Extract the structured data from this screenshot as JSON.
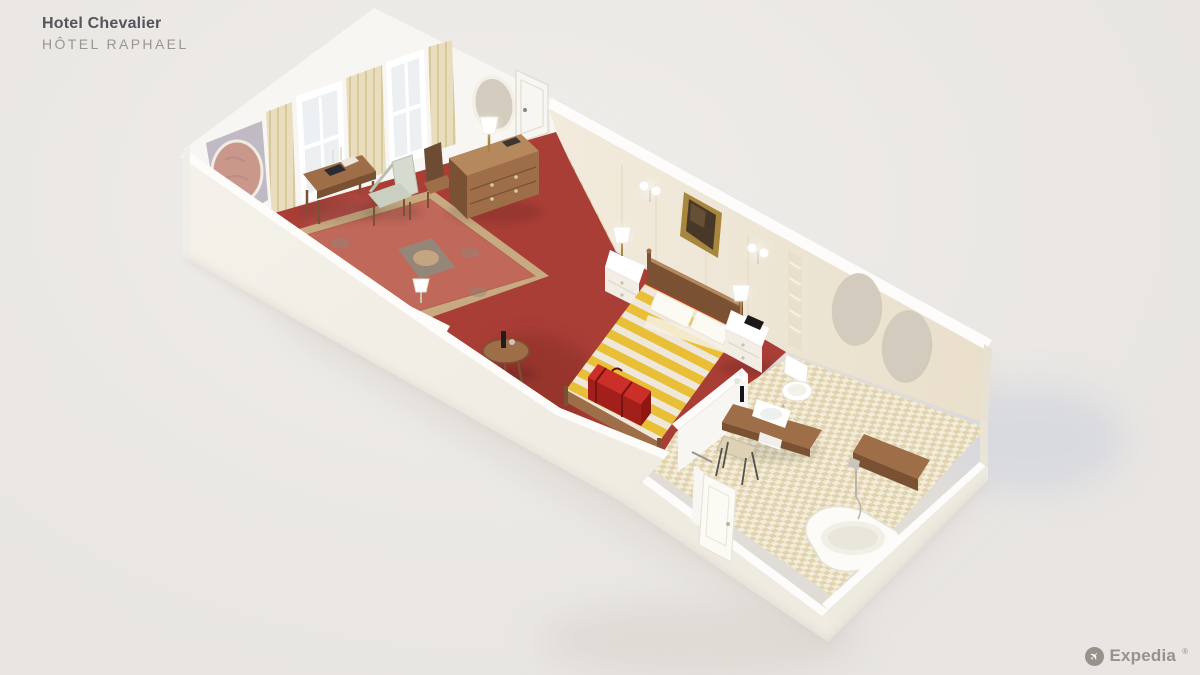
{
  "header": {
    "title": "Hotel Chevalier",
    "subtitle": "HÔTEL RAPHAEL"
  },
  "footer": {
    "brand": "Expedia",
    "registered_mark": "®",
    "plane_icon": "✈"
  },
  "scene": {
    "type": "isometric-floor-plan",
    "subject": "hotel suite cutaway 3D render",
    "rooms": [
      {
        "name": "Living room",
        "floor": "red carpet with oriental rug",
        "furniture": [
          "oriental rug",
          "writing desk with books and candlesticks",
          "armchair",
          "chest of drawers with table lamp",
          "side chair",
          "sofa",
          "fireplace mantel with lamp",
          "round side table with bottle",
          "two windows with cream curtains",
          "round mirror panel",
          "oval mirror",
          "paneled door"
        ]
      },
      {
        "name": "Bedroom",
        "floor": "red carpet",
        "furniture": [
          "double bed with yellow striped duvet",
          "white nightstand with lamp (left)",
          "white nightstand with lamp (right)",
          "gold framed painting",
          "two double wall sconces",
          "red suitcase on foot bench",
          "doorway privacy curtain"
        ]
      },
      {
        "name": "Bathroom",
        "floor": "beige checkered tile",
        "furniture": [
          "wooden vanity with white sink",
          "flower vase",
          "metal stool",
          "toilet",
          "two oval mirrors",
          "towel ladder",
          "bathtub with hand shower",
          "wooden corner bench",
          "open entry door"
        ]
      }
    ]
  },
  "colors": {
    "bg": "#e8e5e2",
    "bg_light": "#efedea",
    "shadow_warm": "#d9d4ce",
    "shadow_cool": "#d6d8df",
    "wall_white": "#f8f6f2",
    "wall_top": "#fdfcfa",
    "wall_cream": "#f2ebdd",
    "wall_cream_dark": "#e9dfcb",
    "wall_gray": "#bfbac3",
    "near_wall": "#f4f1ea",
    "near_wall_dark": "#efebe1",
    "carpet": "#a93e36",
    "carpet_dark": "#862d28",
    "rug_field": "#c0685a",
    "rug_border": "#c8aa82",
    "rug_accent": "#8f8a7c",
    "tile": "#f2ecd9",
    "tile_check": "#dbcba2",
    "wood": "#9e6e48",
    "wood_dark": "#7a5133",
    "wood_light": "#b5885e",
    "bed_yellow": "#f0c837",
    "bed_cream": "#f8f4e9",
    "pillow": "#fbfaf3",
    "suitcase": "#cb2f27",
    "suitcase_dark": "#a31f1b",
    "sage": "#c9cfc1",
    "sage_light": "#d6dbd0",
    "curtain": "#e8debd",
    "curtain_dark": "#d7c99b",
    "glass": "#edf0f2",
    "mirror": "#d3ccbe",
    "mirror_pink": "#c9988b",
    "gold": "#a8863e",
    "painting": "#483828",
    "white": "#ffffff",
    "text_dark": "#55545a",
    "text_gray": "#9b958e",
    "logo": "#97928b"
  }
}
